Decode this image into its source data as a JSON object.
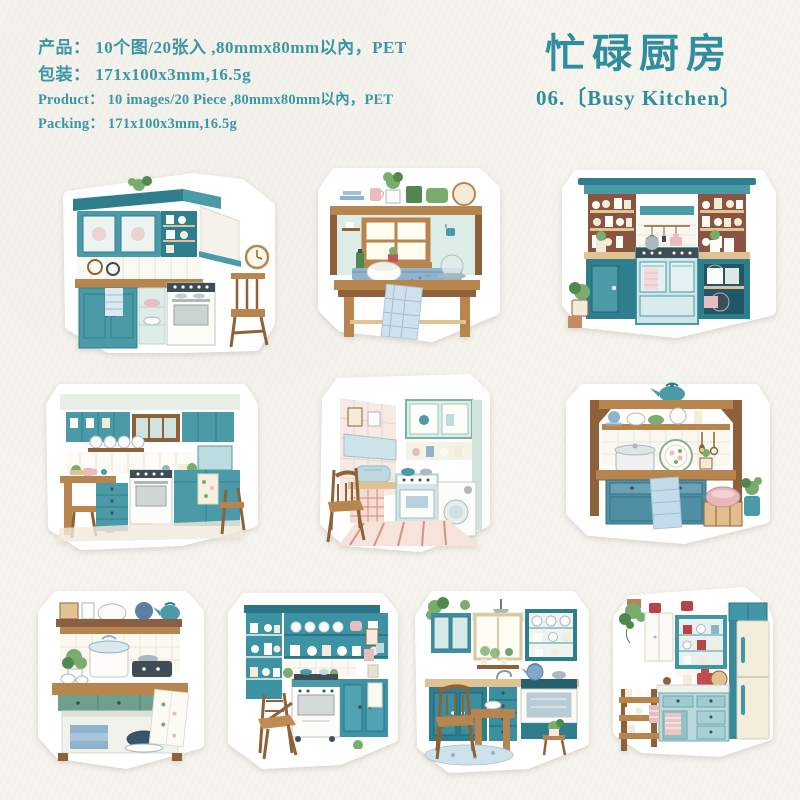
{
  "page": {
    "background_color": "#f6f4ee",
    "accent_color": "#3b96a5",
    "title_color": "#2f8d9e"
  },
  "header": {
    "product_info": [
      "产品： 10个图/20张入 ,80mmx80mm以內，PET",
      "包装： 171x100x3mm,16.5g",
      "Product： 10 images/20 Piece ,80mmx80mm以內，PET",
      "Packing： 171x100x3mm,16.5g"
    ],
    "title_zh": "忙碌厨房",
    "title_en": "06.〔Busy Kitchen〕"
  },
  "stickers": {
    "count": 10,
    "items": [
      {
        "name": "corner-kitchen-with-clock-and-stool"
      },
      {
        "name": "farm-table-with-shelf-and-window"
      },
      {
        "name": "teal-hutch-with-range-cooker"
      },
      {
        "name": "kitchen-room-with-white-stove"
      },
      {
        "name": "retro-mint-kitchen-striped-floor"
      },
      {
        "name": "wood-frame-sideboard-with-kettle"
      },
      {
        "name": "green-bench-with-stock-pot"
      },
      {
        "name": "teal-dish-wall-with-oven-and-folding-chair"
      },
      {
        "name": "window-kitchen-with-chair-and-rug"
      },
      {
        "name": "corner-with-cream-fridge-and-cart"
      }
    ]
  }
}
